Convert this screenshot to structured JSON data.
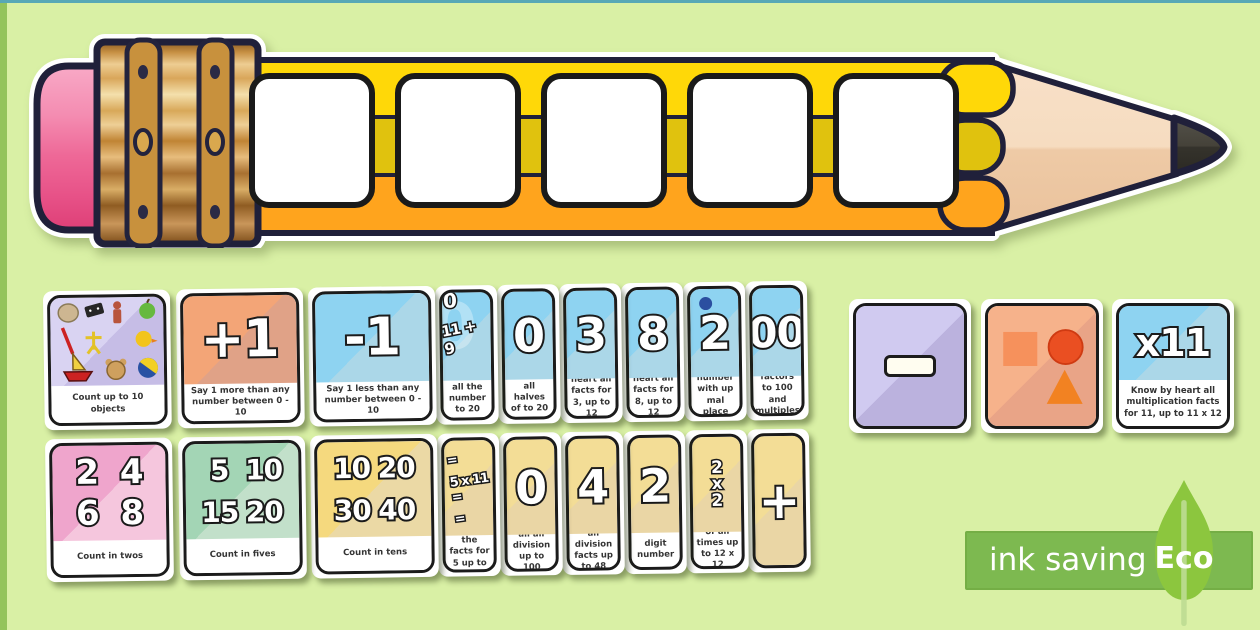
{
  "page": {
    "background_color": "#d9f0a5",
    "top_edge_color": "#58a8b6",
    "left_edge_color": "#94c45c"
  },
  "pencil": {
    "blank_square_count": 5,
    "colors": {
      "eraser": "#ee6897",
      "ferrule": "#d6a053",
      "stripe_top": "#ffd808",
      "stripe_middle": "#e0c20e",
      "stripe_bottom": "#ffa41d",
      "wood": "#f3d6ba",
      "lead": "#3b3932",
      "outline": "#20203a"
    }
  },
  "themes": {
    "lavender": {
      "a": "#d9d3f2",
      "b": "#c6bde6"
    },
    "orange": {
      "a": "#f3a577",
      "b": "#e0a287"
    },
    "blue": {
      "a": "#8ed3f1",
      "b": "#abd7e8"
    },
    "pink": {
      "a": "#efa5cc",
      "b": "#f5c6dd"
    },
    "green": {
      "a": "#a3d5b5",
      "b": "#c2e0ca"
    },
    "yellow": {
      "a": "#f5d97e",
      "b": "#ebd9a5"
    },
    "paleyellow": {
      "a": "#f3dd96",
      "b": "#ead6a5"
    },
    "purple": {
      "a": "#d0caf0",
      "b": "#bbb2de"
    },
    "orange2": {
      "a": "#f6b28b",
      "b": "#e9a487"
    }
  },
  "cards": {
    "top_row": [
      {
        "kind": "objects",
        "name": "count-objects",
        "theme": "lavender",
        "caption": "Count up to 10 objects"
      },
      {
        "kind": "symbol",
        "name": "plus-one",
        "symbol": "+1",
        "theme": "orange",
        "caption": "Say 1 more than any number between 0 - 10"
      },
      {
        "kind": "symbol",
        "name": "minus-one",
        "symbol": "-1",
        "theme": "blue",
        "caption": "Say 1 less than any number between 0 - 10"
      },
      {
        "kind": "bonds",
        "name": "number-bonds",
        "top": "0",
        "symbol": "11 + 9",
        "watermark": "0",
        "theme": "blue",
        "caption": "all the number to 20",
        "partial": true
      },
      {
        "kind": "symbol",
        "name": "halves",
        "symbol": "0",
        "theme": "blue",
        "caption": "all halves of to 20",
        "partial": true
      },
      {
        "kind": "symbol",
        "name": "facts-3",
        "symbol": "3",
        "theme": "blue",
        "caption": "heart all facts for 3, up to 12",
        "partial": true
      },
      {
        "kind": "symbol",
        "name": "facts-8",
        "symbol": "8",
        "theme": "blue",
        "caption": "heart all facts for 8, up to 12",
        "partial": true
      },
      {
        "kind": "symbol",
        "name": "decimal-2",
        "symbol": "2",
        "dot": true,
        "theme": "blue",
        "caption": "number with up mal place",
        "partial": true
      },
      {
        "kind": "symbol",
        "name": "factors-100",
        "symbol": "00",
        "theme": "blue",
        "caption": "recall factors to 100 and multiples of 100",
        "partial": true
      }
    ],
    "bottom_row": [
      {
        "kind": "grid",
        "name": "count-in-twos",
        "numbers": [
          "2",
          "4",
          "6",
          "8"
        ],
        "theme": "pink",
        "caption": "Count in twos"
      },
      {
        "kind": "grid",
        "name": "count-in-fives",
        "numbers": [
          "5",
          "10",
          "15",
          "20"
        ],
        "theme": "green",
        "caption": "Count in fives"
      },
      {
        "kind": "grid",
        "name": "count-in-tens",
        "numbers": [
          "10",
          "20",
          "30",
          "40"
        ],
        "theme": "yellow",
        "caption": "Count in tens"
      },
      {
        "kind": "equations",
        "name": "facts-5",
        "lines": [
          "=",
          "5 x 11 =",
          "="
        ],
        "theme": "paleyellow",
        "caption": "art all the facts for 5 up to 12",
        "partial": true
      },
      {
        "kind": "symbol",
        "name": "division-100",
        "symbol": "0",
        "theme": "paleyellow",
        "caption": "all all division up to 100",
        "partial": true
      },
      {
        "kind": "symbol",
        "name": "division-48",
        "symbol": "4",
        "theme": "paleyellow",
        "caption": "all division facts up to 48",
        "partial": true
      },
      {
        "kind": "symbol",
        "name": "digit-2",
        "symbol": "2",
        "theme": "paleyellow",
        "caption": "digit number",
        "partial": true
      },
      {
        "kind": "stack",
        "name": "times-12x12",
        "lines": [
          "2",
          "x",
          "2"
        ],
        "theme": "paleyellow",
        "caption": "of all times up to 12 x 12",
        "partial": true
      },
      {
        "kind": "symbol",
        "name": "plus-card",
        "symbol": "+",
        "theme": "paleyellow",
        "caption": null,
        "partial": true
      }
    ],
    "side_cards": [
      {
        "kind": "minus",
        "name": "subtraction-symbol",
        "theme": "purple",
        "caption": null
      },
      {
        "kind": "shapes",
        "name": "shapes",
        "theme": "orange2",
        "caption": null
      },
      {
        "kind": "symbol",
        "name": "times-11",
        "symbol": "x11",
        "theme": "blue",
        "caption": "Know by heart all multiplication facts for 11, up to 11 x 12"
      }
    ]
  },
  "eco_badge": {
    "label": "ink saving",
    "eco_label": "Eco"
  }
}
